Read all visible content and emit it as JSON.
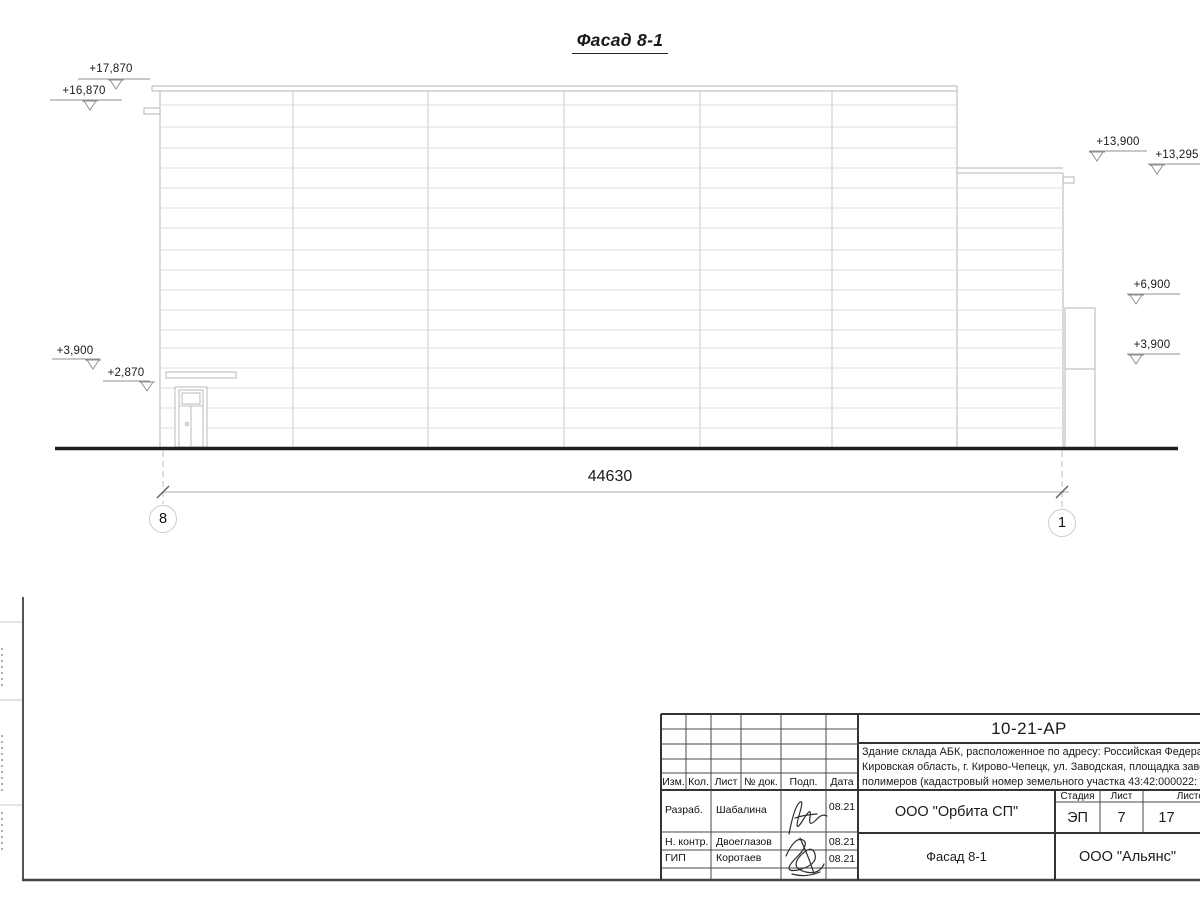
{
  "drawing": {
    "title": "Фасад 8-1",
    "dimension_total": "44630",
    "axis_left": "8",
    "axis_right": "1",
    "elevations": {
      "m17870": "+17,870",
      "m16870": "+16,870",
      "m3900_left": "+3,900",
      "m2870": "+2,870",
      "m13900": "+13,900",
      "m13295": "+13,295",
      "m6900": "+6,900",
      "m3900_right": "+3,900"
    }
  },
  "title_block": {
    "doc_code": "10-21-АР",
    "description_line1": "Здание склада АБК, расположенное по адресу: Российская Федерац",
    "description_line2": "Кировская область, г. Кирово-Чепецк, ул. Заводская, площадка заво",
    "description_line3": "полимеров (кадастровый номер земельного участка 43:42:000022:",
    "columns": {
      "izm": "Изм.",
      "kol": "Кол.",
      "list": "Лист",
      "ndok": "№ док.",
      "podp": "Подп.",
      "data": "Дата"
    },
    "rows": {
      "r1_role": "Разраб.",
      "r1_name": "Шабалина",
      "r1_date": "08.21",
      "r2_role": "Н. контр.",
      "r2_name": "Двоеглазов",
      "r2_date": "08.21",
      "r3_role": "ГИП",
      "r3_name": "Коротаев",
      "r3_date": "08.21"
    },
    "org": "ООО \"Орбита СП\"",
    "stage_label": "Стадия",
    "sheet_label": "Лист",
    "sheets_label": "Листов",
    "stage": "ЭП",
    "sheet": "7",
    "sheets": "17",
    "sheet_title": "Фасад 8-1",
    "firm": "ООО \"Альянс\""
  }
}
